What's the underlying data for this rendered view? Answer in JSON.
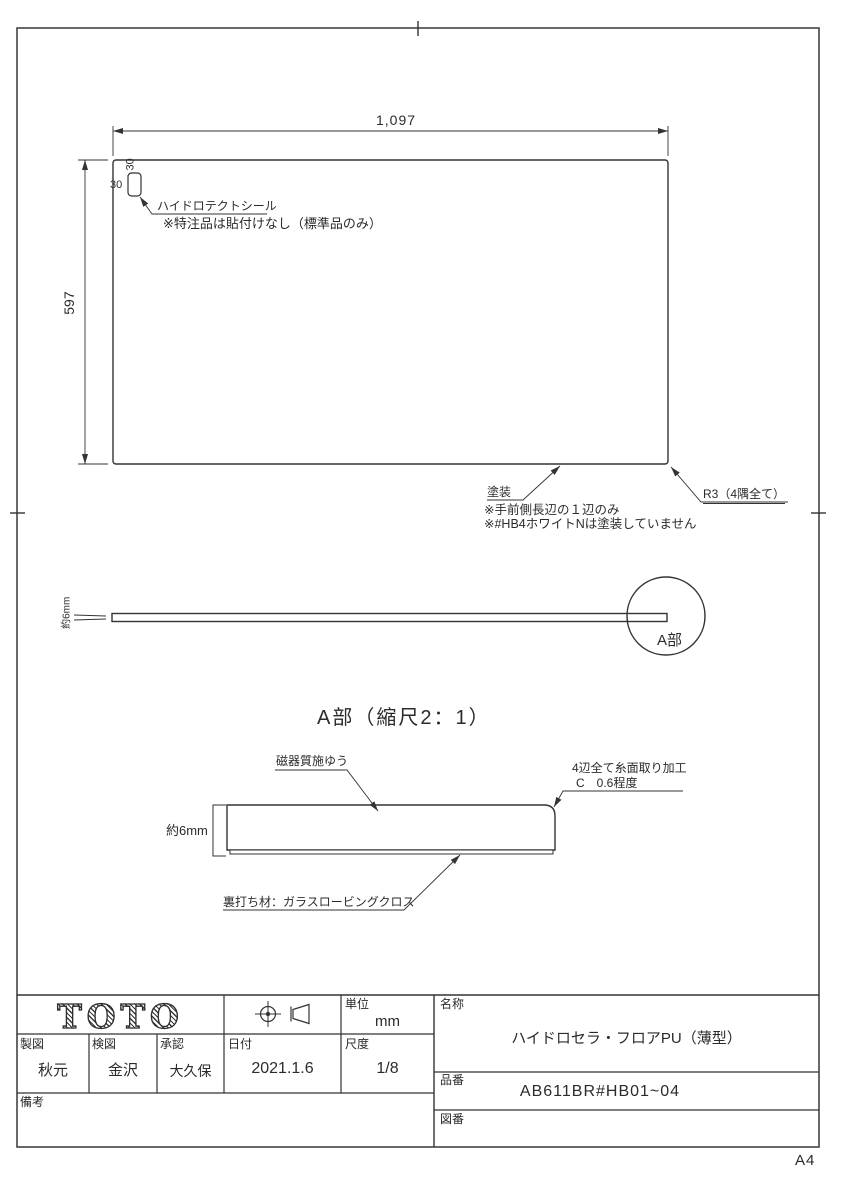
{
  "colors": {
    "ink": "#2b2b2b",
    "paper": "#ffffff"
  },
  "sheet": {
    "size_label": "A4"
  },
  "plan_view": {
    "dim_width": "1,097",
    "dim_height": "597",
    "seal_offset_top": "30",
    "seal_offset_left": "30",
    "seal_label": "ハイドロテクトシール",
    "seal_note": "※特注品は貼付けなし（標準品のみ）",
    "paint_label": "塗装",
    "paint_note_1": "※手前側長辺の１辺のみ",
    "paint_note_2": "※#HB4ホワイトNは塗装していません",
    "corner_radius_label": "R3（4隅全て）"
  },
  "side_view": {
    "thickness_label": "約6mm",
    "detail_mark": "A部"
  },
  "detail_view": {
    "title": "A部（縮尺2：1）",
    "glaze_label": "磁器質施ゆう",
    "chamfer_note_1": "4辺全て糸面取り加工",
    "chamfer_note_2": "C　0.6程度",
    "thickness_label": "約6mm",
    "backing_label": "裏打ち材：ガラスロービングクロス"
  },
  "title_block": {
    "logo": "TOTO",
    "unit": {
      "label": "単位",
      "value": "mm"
    },
    "drafter": {
      "label": "製図",
      "value": "秋元"
    },
    "checker": {
      "label": "検図",
      "value": "金沢"
    },
    "approver": {
      "label": "承認",
      "value": "大久保"
    },
    "date": {
      "label": "日付",
      "value": "2021.1.6"
    },
    "scale": {
      "label": "尺度",
      "value": "1/8"
    },
    "remarks": {
      "label": "備考",
      "value": ""
    },
    "product_name": {
      "label": "名称",
      "value": "ハイドロセラ・フロアPU（薄型）"
    },
    "part_number": {
      "label": "品番",
      "value": "AB611BR#HB01~04"
    },
    "drawing_number": {
      "label": "図番",
      "value": ""
    }
  }
}
